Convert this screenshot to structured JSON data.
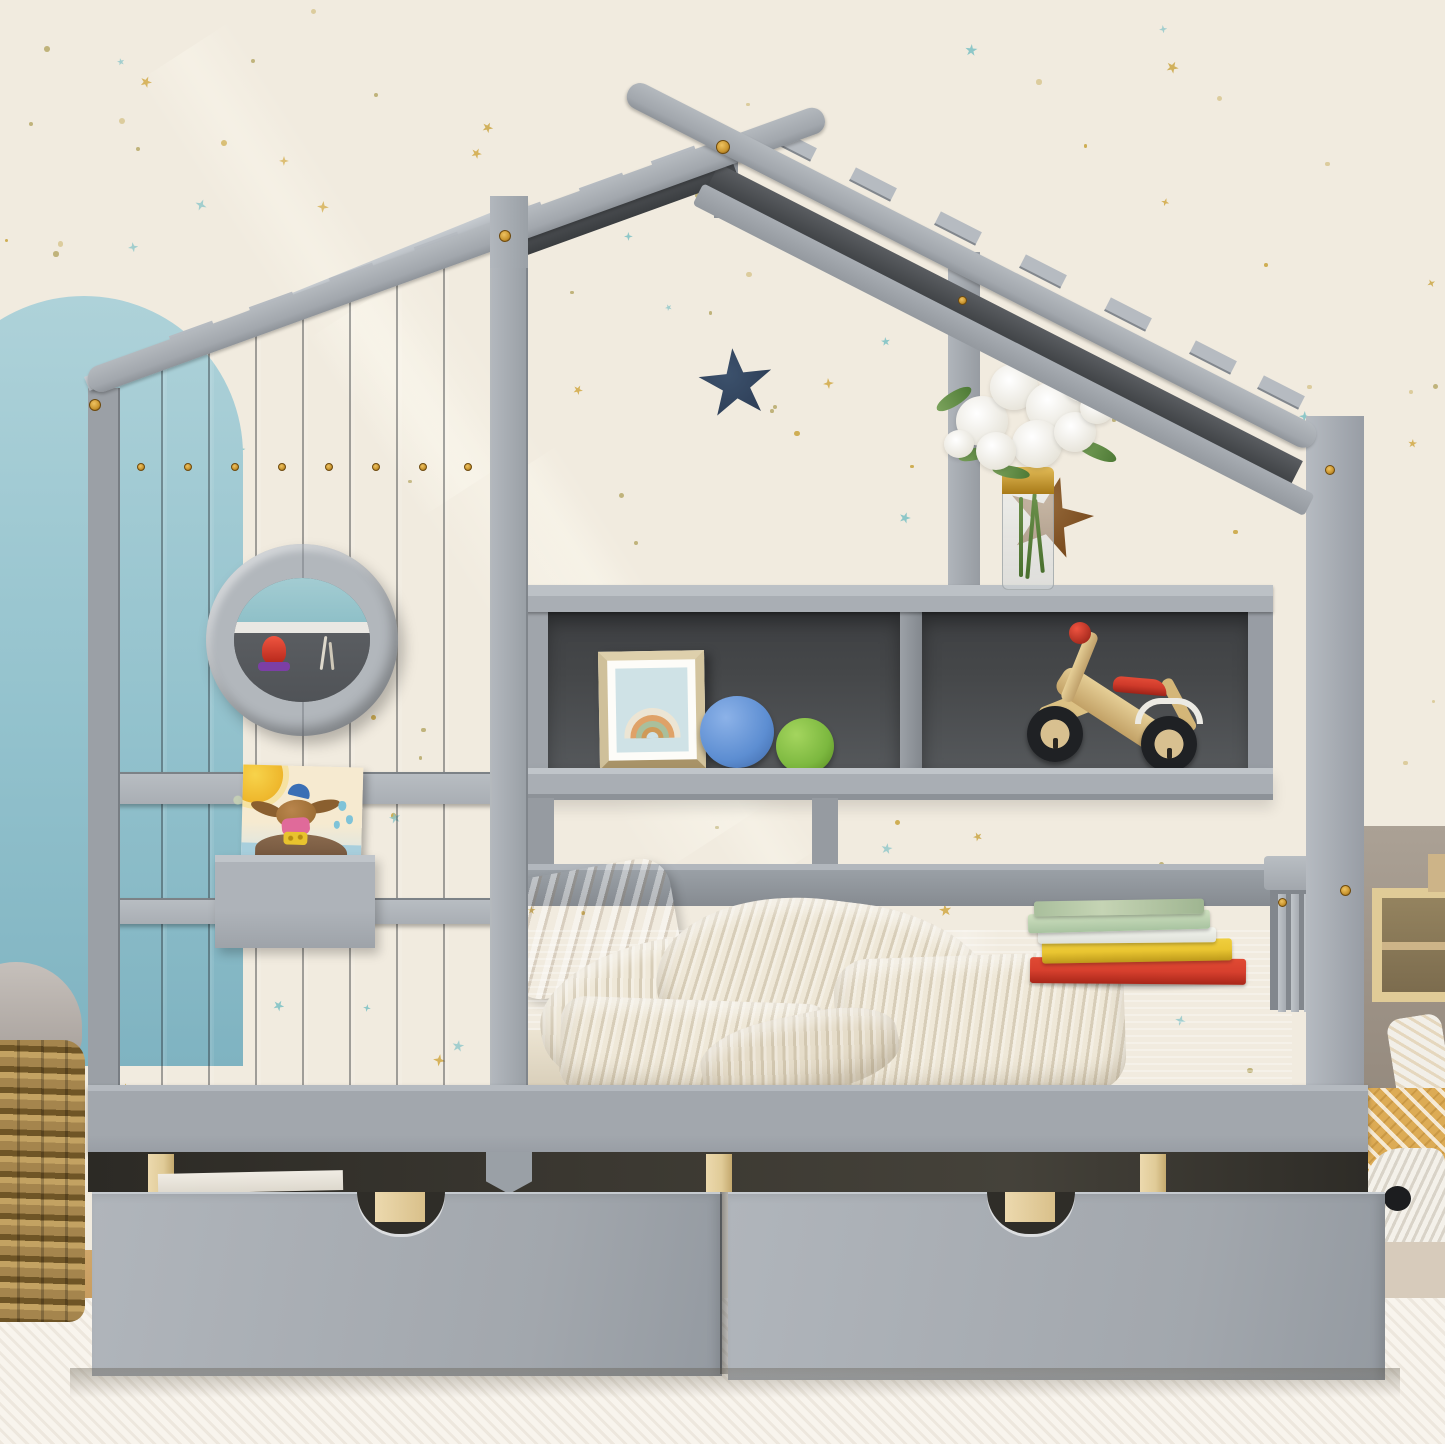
{
  "scene": {
    "description": "Product photo of a gray wooden kids house bed (twin size) with roof cross-beams, plank side wall with round porthole window, built-in cubby shelf, and two under-bed storage drawers, styled in a children room with star wallpaper",
    "setting": "children bedroom with cream star wallpaper, light blue arch wall decal, white carpet"
  },
  "palette": {
    "wall_cream": "#f1ebdf",
    "arch_blue": "#aed2d9",
    "arch_blue_deep": "#7fb3c1",
    "gray_light": "#b7bcc1",
    "gray_mid": "#a7acb2",
    "gray_dark": "#979ca3",
    "gray_deep": "#7e838a",
    "charcoal": "#454749",
    "navy": "#2e3f58",
    "gold": "#c9952f",
    "pine": "#e0cb97",
    "wood_star": "#7b4d20",
    "basket": "#a5854d",
    "carpet": "#f8f4ed",
    "floor_wood": "#c49759",
    "floor_beige": "#d7cbbb",
    "taupe": "#9b9084",
    "red_book": "#d7402e",
    "yellow_book": "#e9c531",
    "mint_book": "#cfe0c0",
    "sage_book": "#a9bf9c",
    "ball_blue": "#5d8ed2",
    "ball_green": "#7cb83f",
    "seat_red": "#cf3a2a",
    "blanket_cream": "#efe8d8",
    "bedding_gray": "#b9bdc1",
    "pillow_beige": "#c8b7a0",
    "star_teal": "#74bec2",
    "star_gold": "#c9a33c",
    "art_blue": "#cfe2e6",
    "frame_gold": "#d3c49e",
    "plush_white": "#f4f0e6",
    "mustard": "#dcab55"
  },
  "wallpaper": {
    "star_count": 72,
    "dot_count": 95,
    "seed": 7,
    "dot_colors": [
      "#c9a33c",
      "#d8c792",
      "#b7a96a"
    ],
    "star_colors": [
      "#74bec2",
      "#cfa43a",
      "#8fc7c9",
      "#c9a33c"
    ]
  },
  "objects": [
    {
      "name": "house-frame-bed",
      "color": "gray",
      "features": [
        "roof cross beams",
        "plank wall",
        "porthole window",
        "cubby shelf",
        "two storage drawers with cutout handles",
        "slatted footboard"
      ]
    },
    {
      "name": "porthole-window",
      "contents": [
        "red toy rocket"
      ]
    },
    {
      "name": "wall-shelf-books",
      "contents": [
        "green picture book",
        "bird picture book"
      ]
    },
    {
      "name": "cubby-shelf-left",
      "contents": [
        "rainbow picture frame",
        "blue ball",
        "green ball"
      ]
    },
    {
      "name": "cubby-shelf-right",
      "contents": [
        "wooden balance bike with red seat"
      ]
    },
    {
      "name": "shelf-top-decor",
      "contents": [
        "glass vase with gold band",
        "white lily bouquet",
        "wooden star"
      ]
    },
    {
      "name": "wall-decor",
      "contents": [
        "navy plush star",
        "light blue arch decal",
        "star pattern wallpaper"
      ]
    },
    {
      "name": "bedding",
      "contents": [
        "beige striped pillow",
        "cream knit blanket",
        "gray ribbed bedspread",
        "stack of books (red, yellow, white, mint, sage)"
      ]
    },
    {
      "name": "floor-props",
      "contents": [
        "white star pillow",
        "woven laundry basket",
        "knit pouf with black dot",
        "mustard polka blanket",
        "wooden cubby shelf"
      ]
    }
  ]
}
